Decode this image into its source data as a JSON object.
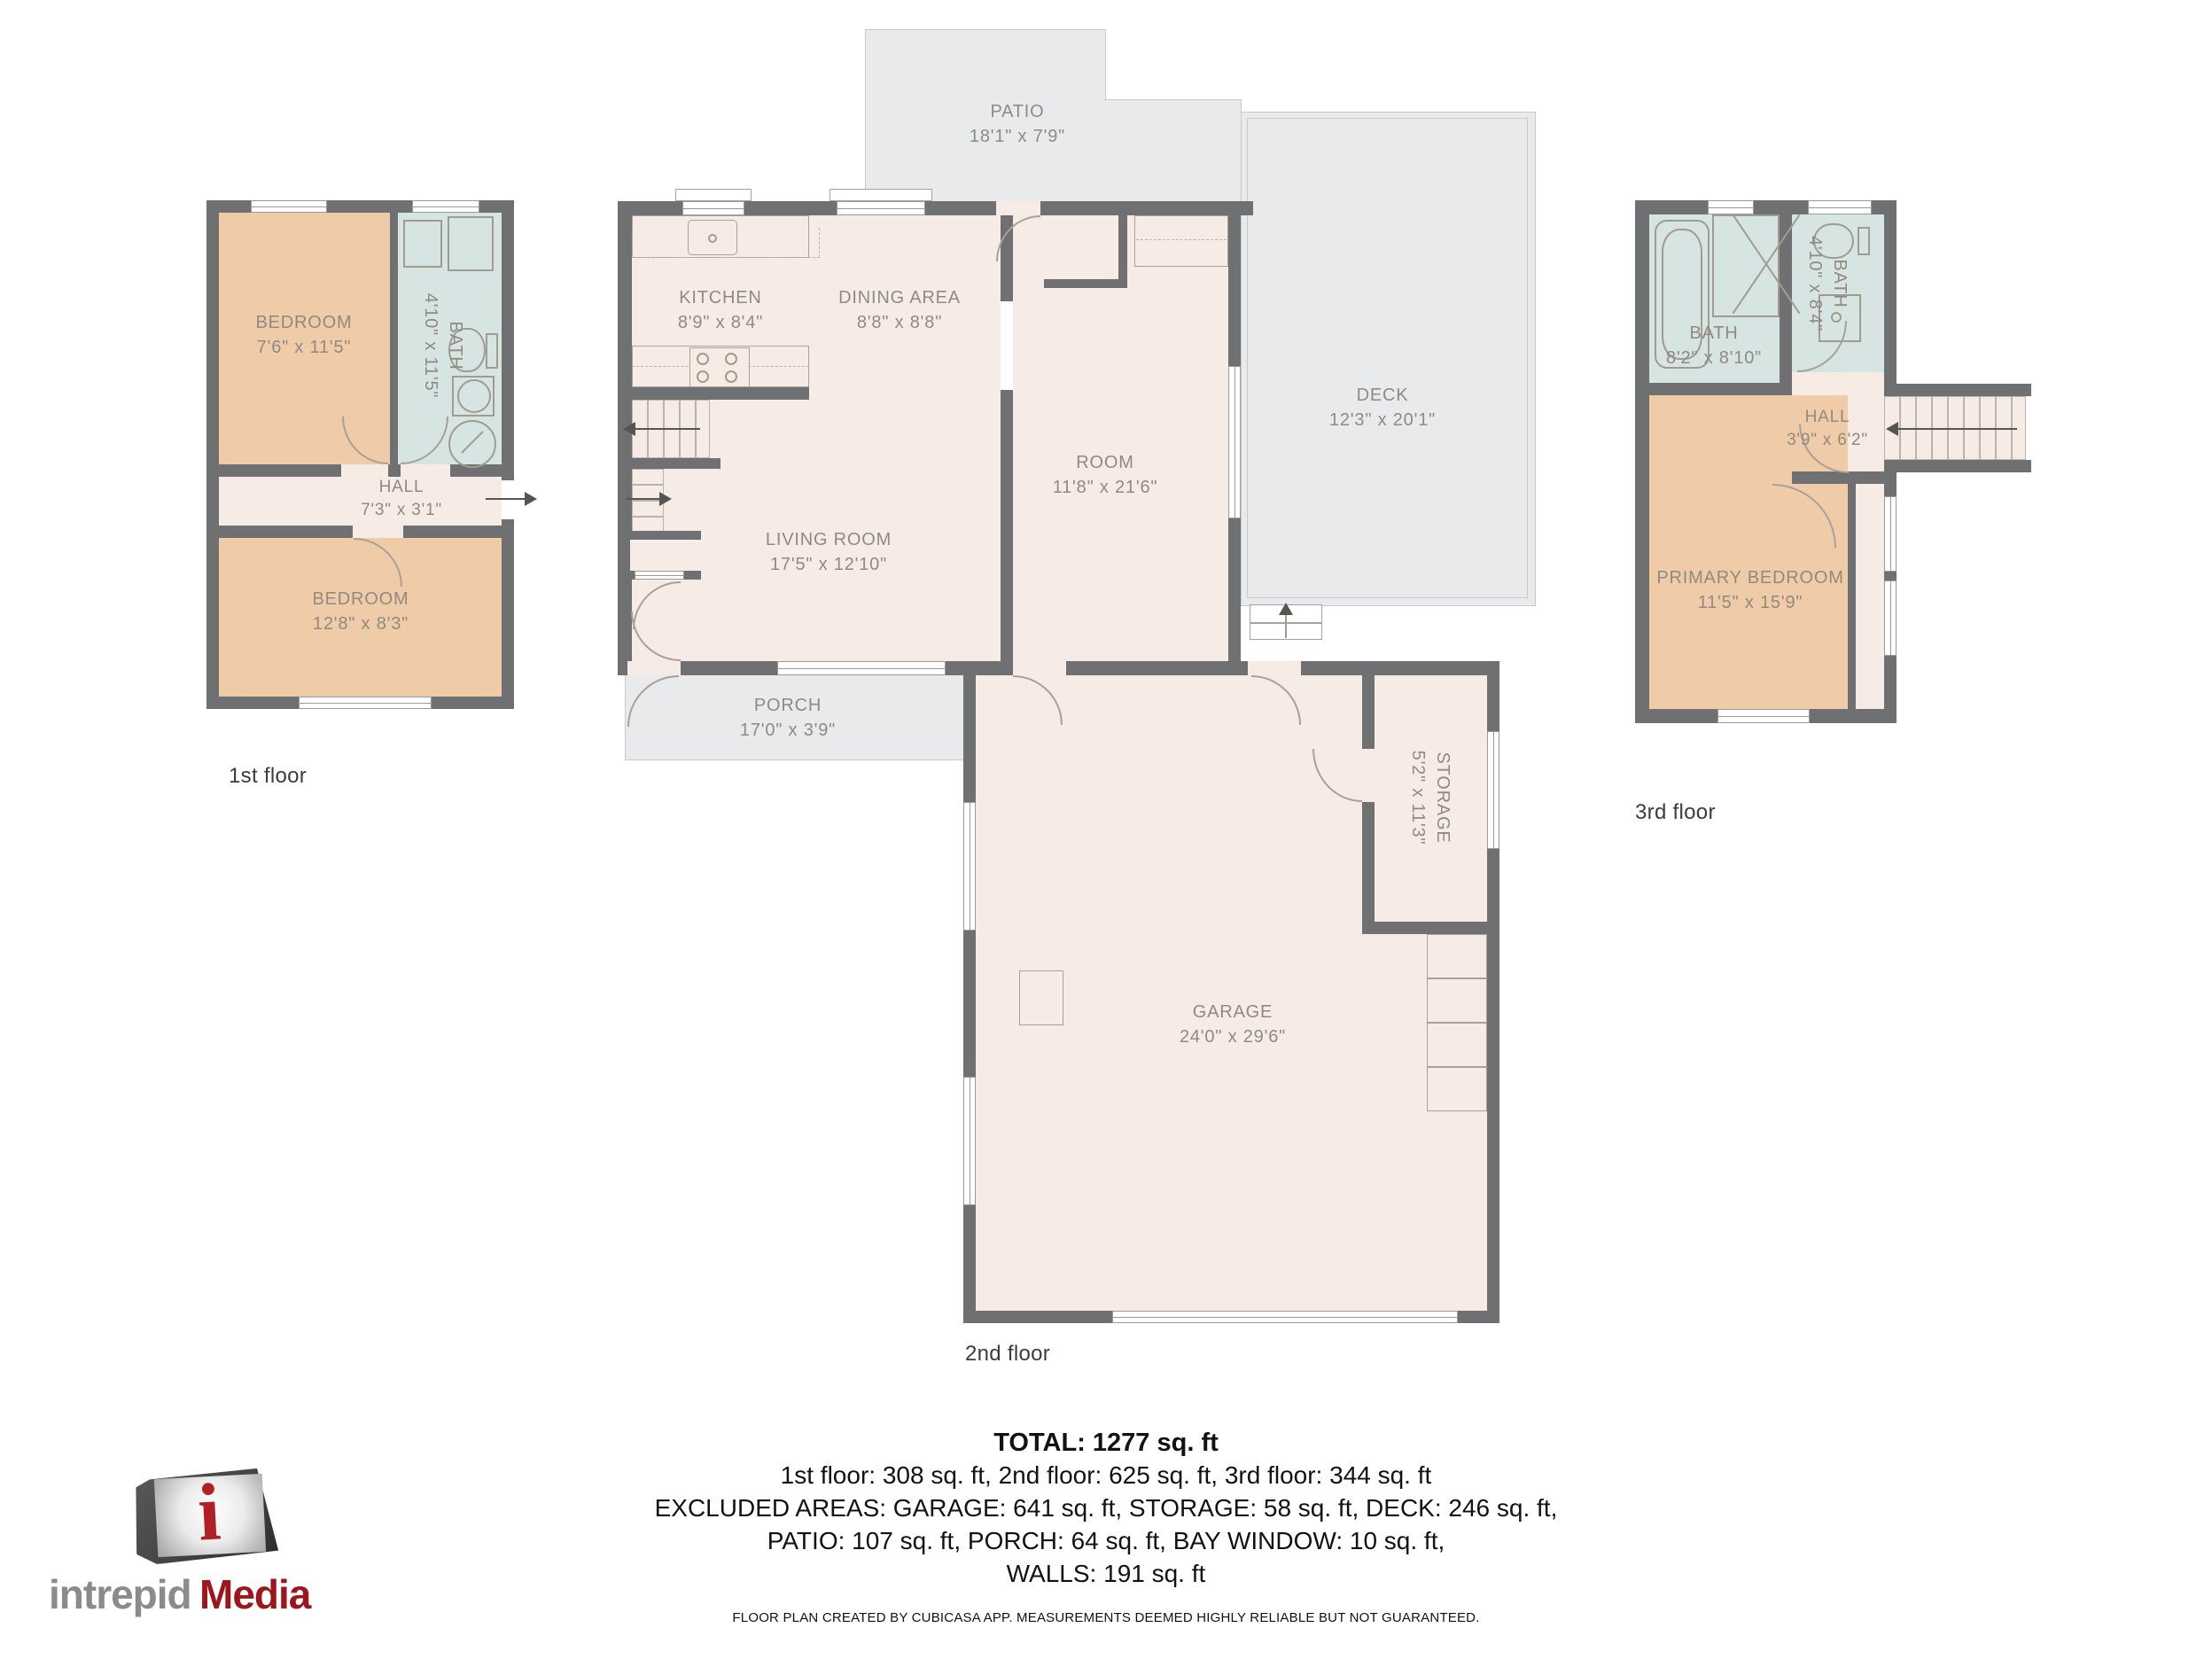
{
  "floors": [
    {
      "label": "1st floor",
      "rooms": [
        {
          "name": "BEDROOM",
          "dims": "7'6\" x 11'5\""
        },
        {
          "name": "BATH",
          "dims": "4'10\" x 11'5\""
        },
        {
          "name": "HALL",
          "dims": "7'3\" x 3'1\""
        },
        {
          "name": "BEDROOM",
          "dims": "12'8\" x 8'3\""
        }
      ]
    },
    {
      "label": "2nd floor",
      "rooms": [
        {
          "name": "PATIO",
          "dims": "18'1\" x 7'9\""
        },
        {
          "name": "KITCHEN",
          "dims": "8'9\" x 8'4\""
        },
        {
          "name": "DINING AREA",
          "dims": "8'8\" x 8'8\""
        },
        {
          "name": "ROOM",
          "dims": "11'8\" x 21'6\""
        },
        {
          "name": "DECK",
          "dims": "12'3\" x 20'1\""
        },
        {
          "name": "LIVING ROOM",
          "dims": "17'5\" x 12'10\""
        },
        {
          "name": "PORCH",
          "dims": "17'0\" x 3'9\""
        },
        {
          "name": "GARAGE",
          "dims": "24'0\" x 29'6\""
        },
        {
          "name": "STORAGE",
          "dims": "5'2\" x 11'3\""
        }
      ]
    },
    {
      "label": "3rd floor",
      "rooms": [
        {
          "name": "BATH",
          "dims": "8'2\" x 8'10\""
        },
        {
          "name": "BATH",
          "dims": "4'10\" x 8'4\""
        },
        {
          "name": "HALL",
          "dims": "3'9\" x 6'2\""
        },
        {
          "name": "PRIMARY BEDROOM",
          "dims": "11'5\" x 15'9\""
        }
      ]
    }
  ],
  "summary": {
    "total": "TOTAL: 1277 sq. ft",
    "line1": "1st floor: 308 sq. ft, 2nd floor: 625 sq. ft, 3rd floor: 344 sq. ft",
    "line2": "EXCLUDED AREAS: GARAGE: 641 sq. ft, STORAGE: 58 sq. ft, DECK: 246 sq. ft,",
    "line3": "PATIO: 107 sq. ft, PORCH: 64 sq. ft, BAY WINDOW: 10 sq. ft,",
    "line4": "WALLS: 191 sq. ft"
  },
  "footer": "FLOOR PLAN CREATED BY CUBICASA APP. MEASUREMENTS DEEMED HIGHLY RELIABLE BUT NOT GUARANTEED.",
  "logo": {
    "part1": "intrepid",
    "part2": "Media",
    "cube_letter": "i"
  },
  "colors": {
    "wall": "#6f7072",
    "room": "#f7ece5",
    "bedroom": "#f0cba7",
    "bath": "#d6e4e2",
    "outdoor": "#e9eaec",
    "label_text": "#8f8a82",
    "logo_gray": "#8b8b8b",
    "logo_red": "#9c161c"
  }
}
